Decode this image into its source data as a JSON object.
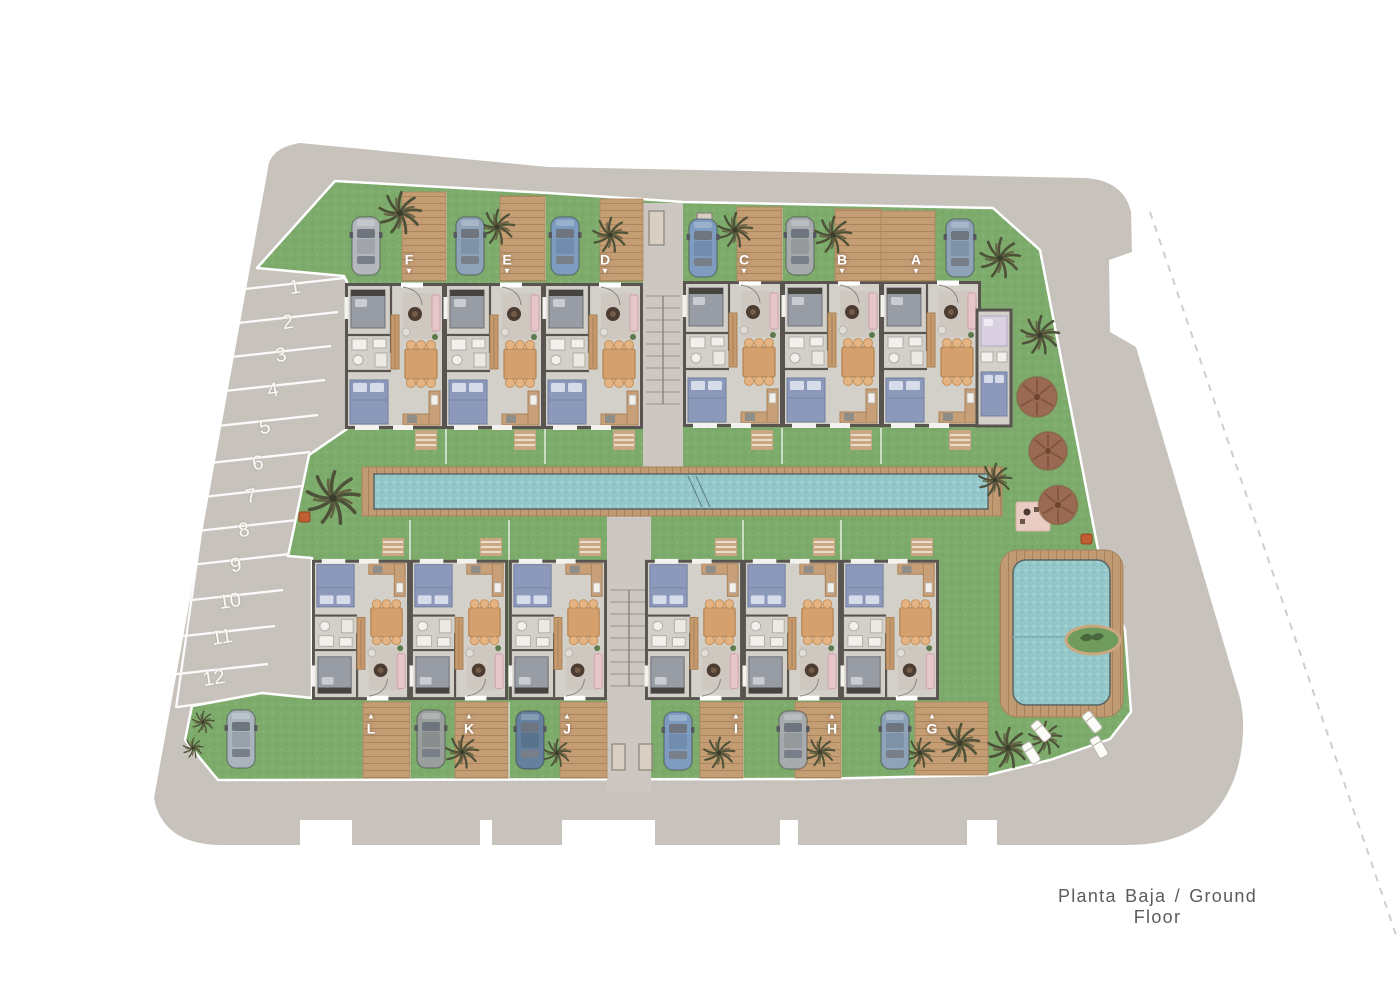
{
  "meta": {
    "caption": "Planta Baja / Ground Floor"
  },
  "units": [
    {
      "label": "F",
      "arrow": "▼"
    },
    {
      "label": "E",
      "arrow": "▼"
    },
    {
      "label": "D",
      "arrow": "▼"
    },
    {
      "label": "C",
      "arrow": "▼"
    },
    {
      "label": "B",
      "arrow": "▼"
    },
    {
      "label": "A",
      "arrow": "▼"
    },
    {
      "label": "L",
      "arrow": "▲"
    },
    {
      "label": "K",
      "arrow": "▲"
    },
    {
      "label": "J",
      "arrow": "▲"
    },
    {
      "label": "I",
      "arrow": "▲"
    },
    {
      "label": "H",
      "arrow": "▲"
    },
    {
      "label": "G",
      "arrow": "▲"
    }
  ],
  "parking": {
    "spaces": [
      "1",
      "2",
      "3",
      "4",
      "5",
      "6",
      "7",
      "8",
      "9",
      "10",
      "11",
      "12"
    ]
  },
  "colors": {
    "road": "#c7c3bc",
    "lawn": "#7dab6c",
    "deck_wood": "#c49d74",
    "pool_water": "#93c7c9",
    "wall": "#59544f",
    "floor": "#d3d0ca",
    "bed_blue": "#8c99ba",
    "furniture_wood": "#d4a06d",
    "round_tree": "#9a6b52",
    "palm": "#4d5138",
    "terrace_pink": "#e9ccc3"
  }
}
